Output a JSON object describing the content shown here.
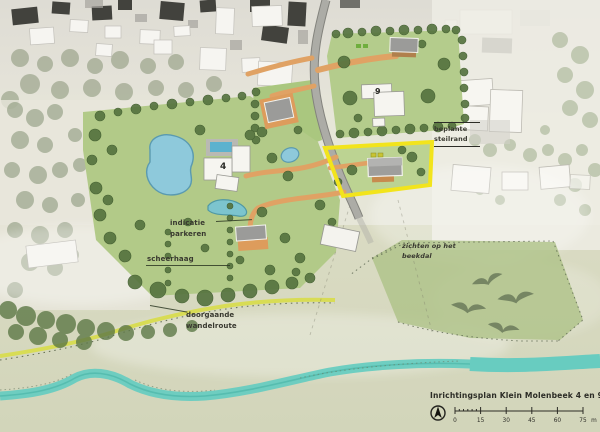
{
  "plan": {
    "title": "Inrichtingsplan Klein Molenbeek 4 en 9",
    "scalebar": {
      "ticks": [
        "0",
        "15",
        "30",
        "45",
        "60",
        "75"
      ],
      "unit": "m"
    },
    "labels": {
      "parking": "indicatie parkeren",
      "hedge": "scheerhaag",
      "route": "doorgaande wandelroute",
      "views": "zichten op het beekdal",
      "slope": "beplante steilrand",
      "house4": "4",
      "house9": "9"
    },
    "colors": {
      "highlight_parcel": "#F2E41C",
      "lawn": "#B2CA88",
      "path_orange": "#E0A264",
      "stream": "#68CCC0",
      "walking_route": "#D8DC55",
      "road": "#A8A8A2"
    }
  }
}
